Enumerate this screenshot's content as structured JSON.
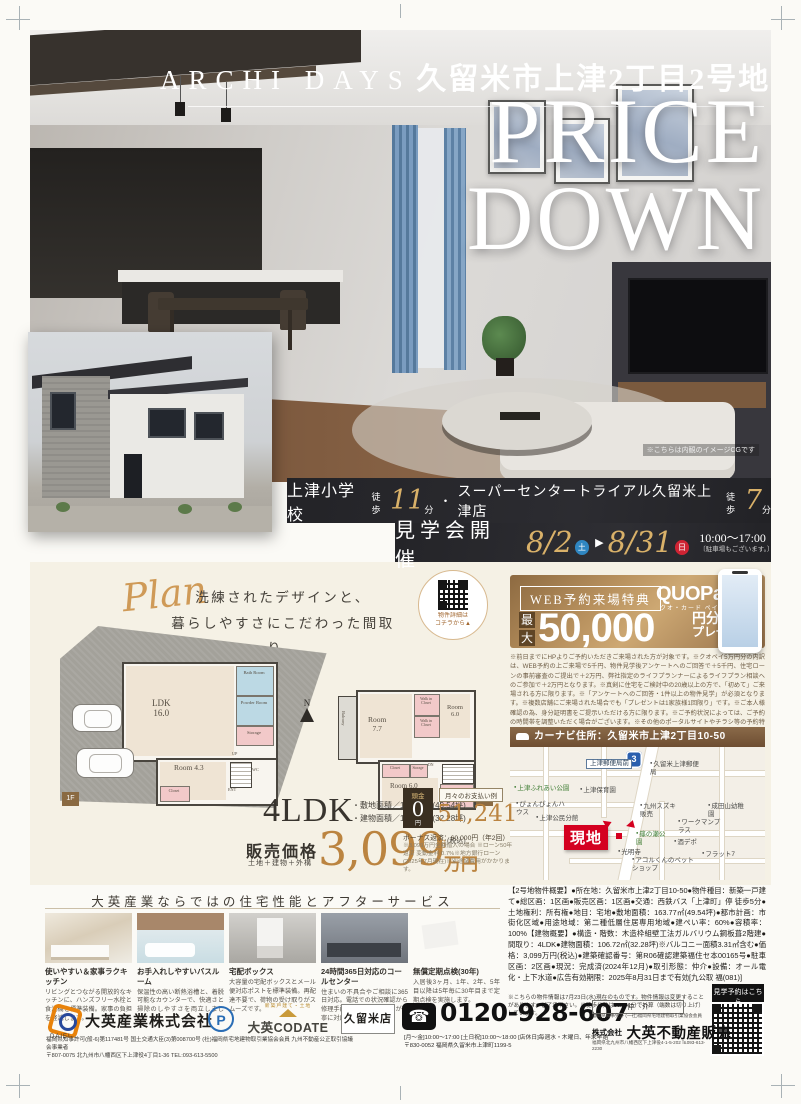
{
  "hero": {
    "brand": "ARCHI DAYS",
    "title": "久留米市上津2丁目2号地",
    "price_line1": "PRICE",
    "price_line2": "DOWN",
    "caption": "※こちらは内観のイメージCGです"
  },
  "access": {
    "spot1": "上津小学校",
    "walk1_label": "徒歩",
    "walk1_min": "11",
    "walk1_unit": "分",
    "dot": "・",
    "spot2": "スーパーセンタートライアル久留米上津店",
    "walk2_label": "徒歩",
    "walk2_min": "7",
    "walk2_unit": "分"
  },
  "event": {
    "title": "見学会開催",
    "start": "8/2",
    "start_day": "土",
    "arrow": "▶",
    "end": "8/31",
    "end_day": "日",
    "time": "10:00〜17:00",
    "note": "〔駐車場もございます。〕"
  },
  "plan": {
    "script": "Plan",
    "copy1": "洗練されたデザインと、",
    "copy2": "暮らしやすさにこだわった間取り。",
    "qr_note1": "物件詳細は",
    "qr_note2": "コチラから▲",
    "compass": "N",
    "f1": {
      "tag": "1F",
      "ldk": "LDK",
      "ldk_size": "16.0",
      "room": "Room",
      "room_size": "4.3",
      "bath": "Bath Room",
      "powder": "Powder Room",
      "storage": "Storage",
      "closet": "Closet",
      "up": "UP",
      "ent": "ENT",
      "wc": "WC"
    },
    "f2": {
      "tag": "2F",
      "balcony": "Balcony",
      "room1": "Room",
      "room1_size": "7.7",
      "wic1": "Walk in Closet",
      "wic2": "Walk in Closet",
      "room2": "Room",
      "room2_size": "6.0",
      "closet": "Closet",
      "storage": "Storage",
      "dn": "DN",
      "room3": "Room",
      "room3_size": "6.0",
      "wic3": "Walk in Closet"
    }
  },
  "campaign": {
    "badge": "WEB予約来場特典",
    "brand": "QUOPay",
    "brand_sub": "クオ・カード ペイ",
    "max1": "最",
    "max2": "大",
    "amount": "50,000",
    "unit": "円分",
    "present": "プレゼント",
    "fine_print": "※前日までにHPよりご予約いただきご来場された方が対象です。※クオペイ5万円分の内訳は、WEB予約の上ご来場で5千円、物件見学後アンケートへのご回答で＋5千円、住宅ローンの事前審査のご提出で＋2万円、弊社指定のライフプランナーによるライフプラン相談へのご参加で＋2万円となります。※真剣に住宅をご検討中の20歳以上の方で、「初めて」ご来場される方に限ります。※「アンケートへのご回答・1件以上の物件見学」が必須となります。※複数店舗にご来場された場合でも「プレゼントは1家族様1回限り」です。※ご本人様確認の為、身分証明書をご提示いただける方に限ります。※ご予約状況によっては、ご予約の時間帯を調整いただく場合がございます。※その他のポータルサイトやチラシ等の予約特典との併用はできません。※業者の方の為のご見学をご希望の方は対象外となります。※クオペイのお渡しは後日の郵送となります。"
  },
  "mapsec": {
    "header": "カーナビ住所：久留米市上津2丁目10-50",
    "route": "3",
    "genchi": "現地",
    "labels": [
      "上津郵便局前",
      "久留米上津郵便局",
      "上津ふれあい公園",
      "ぴょんぴょんハウス",
      "上津公民分館",
      "上津保育園",
      "九州スズキ販売",
      "成田山幼稚園",
      "ワークマンプラス",
      "篠の瀬公園",
      "酒デポ",
      "光明寺",
      "アコルくんのペットショップ",
      "フラット7"
    ]
  },
  "spec": {
    "ldk": "4LDK",
    "land": "・敷地面積／163.77㎡(49.54坪)",
    "bldg": "・建物面積／106.72㎡(32.28坪)",
    "price_label": "販売価格",
    "price_sub": "土地＋建物＋外構",
    "price": "3,099",
    "price_unit": "万円",
    "tax": "(税込)"
  },
  "payment": {
    "down_label": "頭金",
    "down": "0",
    "down_unit": "円",
    "monthly_label": "月々のお支払い例",
    "monthly": "51,241",
    "monthly_unit": "円",
    "bonus": "ボーナス返済：60,000円（年2回）",
    "note": "※3,099万円全額借入の場合 ※ローン50年返済 変動金利 0.7%※地方銀行ローン(2025年7月現在)※別途諸費用がかかります。"
  },
  "services": {
    "title": "大英産業ならではの住宅性能とアフターサービス",
    "items": [
      {
        "title": "使いやすい＆家事ラクキッチン",
        "desc": "リビングとつながる開放的なキッチンに、ハンズフリー水栓と食洗機を標準装備。家事の負担を軽減します。"
      },
      {
        "title": "お手入れしやすいバスルーム",
        "desc": "保温性の高い断熱浴槽と、着脱可能なカウンターで、快適さと掃除のしやすさを両立しました。"
      },
      {
        "title": "宅配ボックス",
        "desc": "大容量の宅配ボックスとメール便対応ポストを標準装備。再配達不要で、荷物の受け取りがスムーズです。"
      },
      {
        "title": "24時間365日対応のコールセンター",
        "desc": "住まいの不具合やご相談に365日対応。電話での状況確認から修理手配まで専門スタッフが丁寧に対応します。"
      },
      {
        "title": "無償定期点検(30年)",
        "desc": "入居後3ヶ月、1年、2年、5年目以降は5年毎に30年目まで定期点検を実施します。"
      }
    ]
  },
  "overview": {
    "body": "【2号地物件概要】●所在地：久留米市上津2丁目10-50●物件種目：新築一戸建て●総区画：1区画●販売区画：1区画●交通：西鉄バス「上津町」停 徒歩5分●土地権利：所有権●地目：宅地●敷地面積：163.77㎡(49.54坪)●都市計画：市街化区域●用途地域：第二種低層住居専用地域●建ぺい率：60%●容積率：100%【建物概要】●構造・階数：木造枠組壁工法ガルバリウム鋼板葺2階建●間取り：4LDK●建物面積：106.72㎡(32.28坪)※バルコニー面積3.31㎡含む●価格：3,099万円(税込)●建築確認番号：第R06確認建築福住セ本00165号●駐車区画：2区画●現況：完成済(2024年12月)●取引形態：仲介●設備：オール電化・上下水道●広告有効期限：2025年8月31日まで有効[九公取 福(081)]",
    "note": "※こちらの物件情報は7月23日(水)現在のものです。物件情報は変更することがあります。ご了承下さい。※徒歩分数は80m=1分で計算（端数は切り上げ）しています。",
    "reserve": "見学予約はこちら"
  },
  "footer": {
    "daiei": "DAIEI",
    "company": "大英産業株式会社",
    "license1": "福岡県知事許可(般-6)第117481号 国土交通大臣(3)第008700号 (社)福岡県宅地建物取引業協会会員 九州不動産公正取引協議会事業者",
    "license2": "〒807-0075 北九州市八幡西区下上津役4丁目1-36 TEL:093-613-5500",
    "pmark": "P",
    "codate_sub": "新築戸建て・土地",
    "codate": "大英CODATE",
    "store": "久留米店",
    "tel_icon": "☎",
    "phone": "0120-928-607",
    "hours": "[月〜金]10:00〜17:00 [土日祝]10:00〜18:00 [店休日]毎週水・木曜日、年末年始",
    "address": "〒830-0052 福岡県久留米市上津町1199-5",
    "broker": "仲介",
    "sales_license": "福岡県知事免許 (一社)福岡県宅地建物取引業協会会員",
    "sales_prefix": "株式会社",
    "sales_company": "大英不動産販売",
    "sales_address": "福岡県北九州市八幡西区下上津役4-1-5-202 ℡093-613-2230"
  }
}
